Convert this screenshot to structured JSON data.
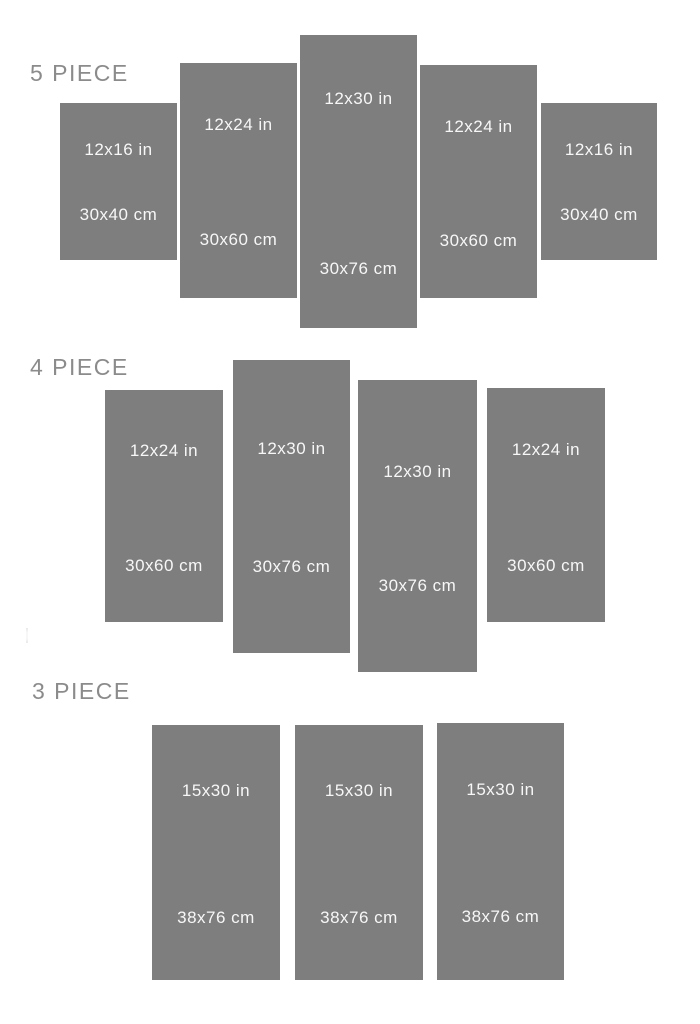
{
  "title": "Canvas panel size chart",
  "colors": {
    "background": "#ffffff",
    "panel_fill": "#7e7e7e",
    "panel_text": "#f7f7f7",
    "section_label_text": "#8b8b8b"
  },
  "sections": [
    {
      "label": "5 PIECE",
      "panels": [
        {
          "inches": "12x16 in",
          "cm": "30x40 cm"
        },
        {
          "inches": "12x24 in",
          "cm": "30x60 cm"
        },
        {
          "inches": "12x30 in",
          "cm": "30x76 cm"
        },
        {
          "inches": "12x24 in",
          "cm": "30x60 cm"
        },
        {
          "inches": "12x16 in",
          "cm": "30x40 cm"
        }
      ]
    },
    {
      "label": "4 PIECE",
      "panels": [
        {
          "inches": "12x24 in",
          "cm": "30x60 cm"
        },
        {
          "inches": "12x30 in",
          "cm": "30x76 cm"
        },
        {
          "inches": "12x30 in",
          "cm": "30x76 cm"
        },
        {
          "inches": "12x24 in",
          "cm": "30x60 cm"
        }
      ]
    },
    {
      "label": "3 PIECE",
      "panels": [
        {
          "inches": "15x30 in",
          "cm": "38x76 cm"
        },
        {
          "inches": "15x30 in",
          "cm": "38x76 cm"
        },
        {
          "inches": "15x30 in",
          "cm": "38x76 cm"
        }
      ]
    }
  ]
}
